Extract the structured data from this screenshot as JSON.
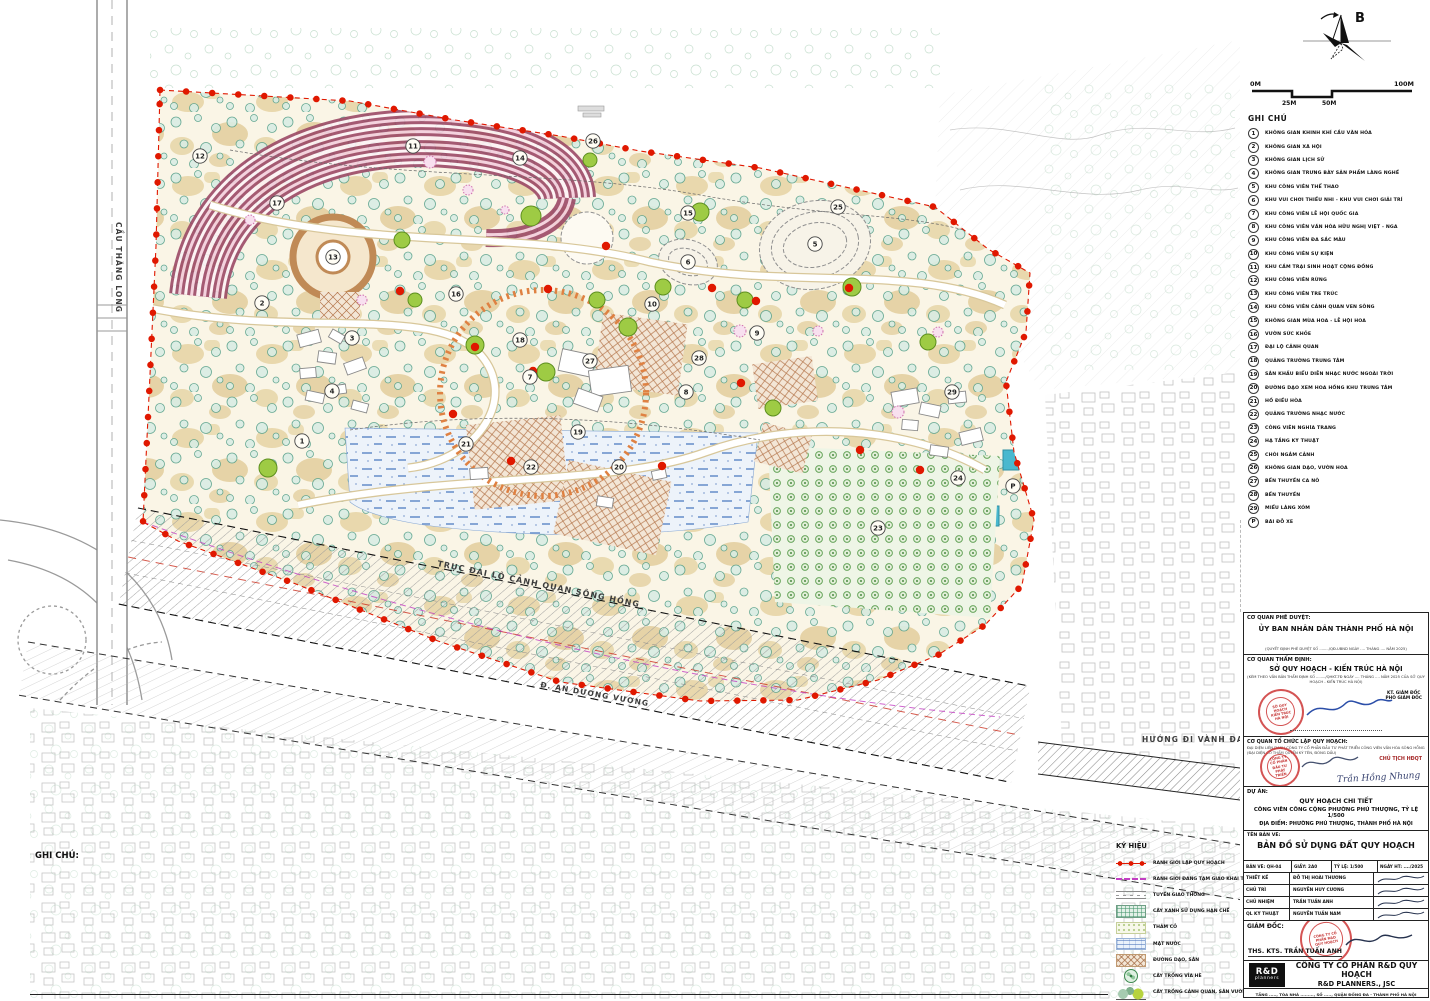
{
  "north_label": "B",
  "scale_bar": {
    "left": "0M",
    "right": "100M",
    "mid1": "25M",
    "mid2": "50M"
  },
  "map_labels": {
    "bridge": "CẦU THĂNG LONG",
    "boulevard": "TRỤC ĐẠI LỘ CẢNH QUAN SÔNG HỒNG",
    "street": "Đ. AN DƯƠNG VƯƠNG",
    "ring_road": "HƯỚNG ĐI VÀNH ĐAI 2"
  },
  "colors": {
    "boundary_red": "#e01800",
    "orange_ring": "#df8142",
    "water_blue": "#6d92cc",
    "rose_stripe": "#9c4a66",
    "tan_path": "#e7d5a7",
    "tree_teal": "#55a089",
    "tree_lime": "#9ecb44",
    "stamp_red": "#c82323",
    "signature_blue": "#2b4ea8"
  },
  "plan": {
    "markers": [
      {
        "n": "1",
        "x": 302,
        "y": 441
      },
      {
        "n": "2",
        "x": 262,
        "y": 303
      },
      {
        "n": "3",
        "x": 352,
        "y": 338
      },
      {
        "n": "4",
        "x": 332,
        "y": 391
      },
      {
        "n": "5",
        "x": 815,
        "y": 244
      },
      {
        "n": "6",
        "x": 688,
        "y": 262
      },
      {
        "n": "7",
        "x": 530,
        "y": 377
      },
      {
        "n": "8",
        "x": 686,
        "y": 392
      },
      {
        "n": "9",
        "x": 757,
        "y": 333
      },
      {
        "n": "10",
        "x": 652,
        "y": 304
      },
      {
        "n": "11",
        "x": 413,
        "y": 146
      },
      {
        "n": "12",
        "x": 200,
        "y": 156
      },
      {
        "n": "13",
        "x": 333,
        "y": 257
      },
      {
        "n": "14",
        "x": 520,
        "y": 158
      },
      {
        "n": "15",
        "x": 688,
        "y": 213
      },
      {
        "n": "16",
        "x": 456,
        "y": 294
      },
      {
        "n": "17",
        "x": 277,
        "y": 203
      },
      {
        "n": "18",
        "x": 520,
        "y": 340
      },
      {
        "n": "19",
        "x": 578,
        "y": 432
      },
      {
        "n": "20",
        "x": 619,
        "y": 467
      },
      {
        "n": "21",
        "x": 466,
        "y": 444
      },
      {
        "n": "22",
        "x": 531,
        "y": 467
      },
      {
        "n": "23",
        "x": 878,
        "y": 528
      },
      {
        "n": "24",
        "x": 958,
        "y": 478
      },
      {
        "n": "25",
        "x": 838,
        "y": 207
      },
      {
        "n": "26",
        "x": 593,
        "y": 141
      },
      {
        "n": "27",
        "x": 590,
        "y": 361
      },
      {
        "n": "28",
        "x": 699,
        "y": 358
      },
      {
        "n": "29",
        "x": 952,
        "y": 392
      },
      {
        "n": "P",
        "x": 1013,
        "y": 486
      }
    ]
  },
  "ghi_chu": {
    "title": "GHI CHÚ",
    "items": [
      {
        "n": "1",
        "label": "KHÔNG GIAN KHINH KHÍ CẦU VĂN HÓA"
      },
      {
        "n": "2",
        "label": "KHÔNG GIAN XÃ HỘI"
      },
      {
        "n": "3",
        "label": "KHÔNG GIAN LỊCH SỬ"
      },
      {
        "n": "4",
        "label": "KHÔNG GIAN TRƯNG BÀY SẢN PHẨM LÀNG NGHỀ"
      },
      {
        "n": "5",
        "label": "KHU CÔNG VIÊN THỂ THAO"
      },
      {
        "n": "6",
        "label": "KHU VUI CHƠI THIẾU NHI - KHU VUI CHƠI GIẢI TRÍ"
      },
      {
        "n": "7",
        "label": "KHU CÔNG VIÊN LỄ HỘI QUỐC GIA"
      },
      {
        "n": "8",
        "label": "KHU CÔNG VIÊN VĂN HÓA HỮU NGHỊ VIỆT - NGA"
      },
      {
        "n": "9",
        "label": "KHU CÔNG VIÊN ĐA SẮC MÀU"
      },
      {
        "n": "10",
        "label": "KHU CÔNG VIÊN SỰ KIỆN"
      },
      {
        "n": "11",
        "label": "KHU CẮM TRẠI SINH HOẠT CỘNG ĐỒNG"
      },
      {
        "n": "12",
        "label": "KHU CÔNG VIÊN RỪNG"
      },
      {
        "n": "13",
        "label": "KHU CÔNG VIÊN TRE TRÚC"
      },
      {
        "n": "14",
        "label": "KHU CÔNG VIÊN CẢNH QUAN VEN SÔNG"
      },
      {
        "n": "15",
        "label": "KHÔNG GIAN MÙA HOA - LỄ HỘI HOA"
      },
      {
        "n": "16",
        "label": "VƯỜN SỨC KHỎE"
      },
      {
        "n": "17",
        "label": "ĐẠI LỘ CẢNH QUAN"
      },
      {
        "n": "18",
        "label": "QUẢNG TRƯỜNG TRUNG TÂM"
      },
      {
        "n": "19",
        "label": "SÂN KHẤU BIỂU DIỄN NHẠC NƯỚC NGOÀI TRỜI"
      },
      {
        "n": "20",
        "label": "ĐƯỜNG DẠO XEM HOA HỒNG KHU TRUNG TÂM"
      },
      {
        "n": "21",
        "label": "HỒ ĐIỀU HÒA"
      },
      {
        "n": "22",
        "label": "QUẢNG TRƯỜNG NHẠC NƯỚC"
      },
      {
        "n": "23",
        "label": "CÔNG VIÊN NGHĨA TRANG"
      },
      {
        "n": "24",
        "label": "HẠ TẦNG KỸ THUẬT"
      },
      {
        "n": "25",
        "label": "CHÒI NGẮM CẢNH"
      },
      {
        "n": "26",
        "label": "KHÔNG GIAN DẠO, VƯỜN HOA"
      },
      {
        "n": "27",
        "label": "BẾN THUYỀN CA NÔ"
      },
      {
        "n": "28",
        "label": "BẾN THUYỀN"
      },
      {
        "n": "29",
        "label": "MIẾU LÀNG XÓM"
      },
      {
        "n": "P",
        "label": "BÃI ĐỖ XE"
      }
    ]
  },
  "ky_hieu": {
    "title": "KÝ HIỆU",
    "items": [
      {
        "swatch": "sw-boundary",
        "label": "RANH GIỚI LẬP QUY HOẠCH"
      },
      {
        "swatch": "sw-temp",
        "label": "RANH GIỚI ĐANG TẠM GIAO KHAI THÁC CỘNG ĐỒNG"
      },
      {
        "swatch": "sw-road",
        "label": "TUYẾN GIAO THÔNG"
      },
      {
        "swatch": "sw-greencheck",
        "label": "CÂY XANH SỬ DỤNG HẠN CHẾ"
      },
      {
        "swatch": "sw-grass",
        "label": "THẢM CỎ"
      },
      {
        "swatch": "sw-water",
        "label": "MẶT NƯỚC"
      },
      {
        "swatch": "sw-paving",
        "label": "ĐƯỜNG DẠO, SÂN"
      },
      {
        "swatch": "sw-tree1",
        "label": "CÂY TRỒNG VỈA HÈ"
      },
      {
        "swatch": "sw-tree2",
        "label": "CÂY TRỒNG CẢNH QUAN, SÂN VƯỜN"
      }
    ]
  },
  "notes": {
    "title": "GHI CHÚ:",
    "paragraphs": [
      "-    CHỨC NĂNG SỬ DỤNG ĐẤT VÀ CÁC CHỈ TIÊU QUY HOẠCH KIẾN TRÚC XÁC ĐỊNH CỤ THỂ TẠI BẢN ĐỒ SỬ DỤNG ĐẤT QUY HOẠCH (QH-04).",
      "-    THEO CÔNG VĂN SỐ 1000/SNNMT-TLPCTT NGÀY 16/12/2025 CỦA SỞ NÔNG NGHIỆP VÀ MÔI TRƯỜNG “VỀ MẬT ĐỘ XÂY DỰNG THEO QUY HOẠCH PHÒNG CHỐNG LŨ”, KHU VỰC NÀY KHÔNG ĐƯỢC XÂY DỰNG CÔNG TRÌNH NHÀ Ở MỚI; CÔNG TRÌNH HẠ TẦNG KHÔNG TÍNH VÀO MẬT ĐỘ XÂY DỰNG; CÔNG TRÌNH TẠO CẢNH QUAN CẦN BỐ TRÍ XUÔI THUẬN THEO CHIỀU DÒNG CHẢY, HẠN CHẾ CẢN TRỞ ĐẾN DÒNG CHẢY, THOÁT LŨ; ĐẢM BẢO TUÂN THỦ LUẬT ĐÊ ĐIỀU, QUY CHUẨN XÂY DỰNG VIỆT NAM VÀ QUY ĐỊNH HIỆN HÀNH.",
      "-    CÁC CÔNG TRÌNH KHÔNG XÂY DỰNG TƯỜNG BAO, MÁI; CÔNG TRÌNH KHÔNG KIÊN CỐ VÀ SỬ DỤNG CÁC VẬT LIỆU ĐỊA PHƯƠNG."
    ]
  },
  "title_block": {
    "approve_label": "CƠ QUAN PHÊ DUYỆT:",
    "approve_name": "ỦY BAN NHÂN DÂN THÀNH PHỐ HÀ NỘI",
    "approve_note": "(QUYẾT ĐỊNH PHÊ DUYỆT SỐ ......../QĐ-UBND NGÀY .... THÁNG .... NĂM 2025)",
    "appraise_label": "CƠ QUAN THẨM ĐỊNH:",
    "appraise_name": "SỞ QUY HOẠCH - KIẾN TRÚC HÀ NỘI",
    "appraise_note": "(KÈM THEO VĂN BẢN THẨM ĐỊNH SỐ ......../QHKT-TĐ NGÀY .... THÁNG .... NĂM 2025 CỦA SỞ QUY HOẠCH - KIẾN TRÚC HÀ NỘI)",
    "appraise_sign_title": "KT. GIÁM ĐỐC",
    "appraise_sign_title2": "PHÓ GIÁM ĐỐC",
    "stamp_agency": "SỞ QUY HOẠCH KIẾN TRÚC HÀ NỘI",
    "organizer_label": "CƠ QUAN TỔ CHỨC LẬP QUY HOẠCH:",
    "organizer_note": "ĐẠI DIỆN LIÊN DANH CÔNG TY CỔ PHẦN ĐẦU TƯ PHÁT TRIỂN CÔNG VIÊN VĂN HÓA SÔNG HỒNG",
    "organizer_note2": "(ĐẠI DIỆN CÓ THẨM QUYỀN KÝ TÊN, ĐÓNG DẤU)",
    "organizer_sign_title": "CHỦ TỊCH HĐQT",
    "organizer_sign_name": "Trần Hồng Nhung",
    "stamp_investor": "CÔNG TY CỔ PHẦN ĐẦU TƯ PHÁT TRIỂN",
    "project_label": "DỰ ÁN:",
    "project_line1": "QUY HOẠCH CHI TIẾT",
    "project_line2": "CÔNG VIÊN CÔNG CỘNG PHƯỜNG PHÚ THƯỢNG, TỶ LỆ 1/500",
    "project_line3": "ĐỊA ĐIỂM: PHƯỜNG PHÚ THƯỢNG, THÀNH PHỐ HÀ NỘI",
    "drawing_label": "TÊN BẢN VẼ:",
    "drawing_name": "BẢN ĐỒ SỬ DỤNG ĐẤT QUY HOẠCH",
    "info": {
      "sheet": "BẢN VẼ:  QH-04",
      "paper": "GIẤY: 2A0",
      "scale": "TỶ LỆ:  1/500",
      "date": "NGÀY HT: ..../2025"
    },
    "crew": [
      {
        "role": "THIẾT KẾ",
        "name": "ĐỖ THỊ HOÀI THƯƠNG"
      },
      {
        "role": "CHỦ TRÌ",
        "name": "NGUYỄN HUY CƯƠNG"
      },
      {
        "role": "CHỦ NHIỆM",
        "name": "TRẦN TUẤN ANH"
      },
      {
        "role": "QL KỸ THUẬT",
        "name": "NGUYỄN TUẤN NAM"
      }
    ],
    "director_label": "GIÁM ĐỐC:",
    "director_name": "THS. KTS. TRẦN TUẤN ANH",
    "stamp_company": "CÔNG TY CỔ PHẦN R&D QUY HOẠCH",
    "company_logo_top": "R&D",
    "company_logo_bottom": "planners",
    "company_line1": "CÔNG TY CỔ PHẦN R&D QUY HOẠCH",
    "company_line2": "R&D PLANNERS., JSC",
    "address": "TẦNG ....., TÒA NHÀ ........., SỐ ....., QUẬN ĐỐNG ĐA - THÀNH PHỐ HÀ NỘI"
  }
}
